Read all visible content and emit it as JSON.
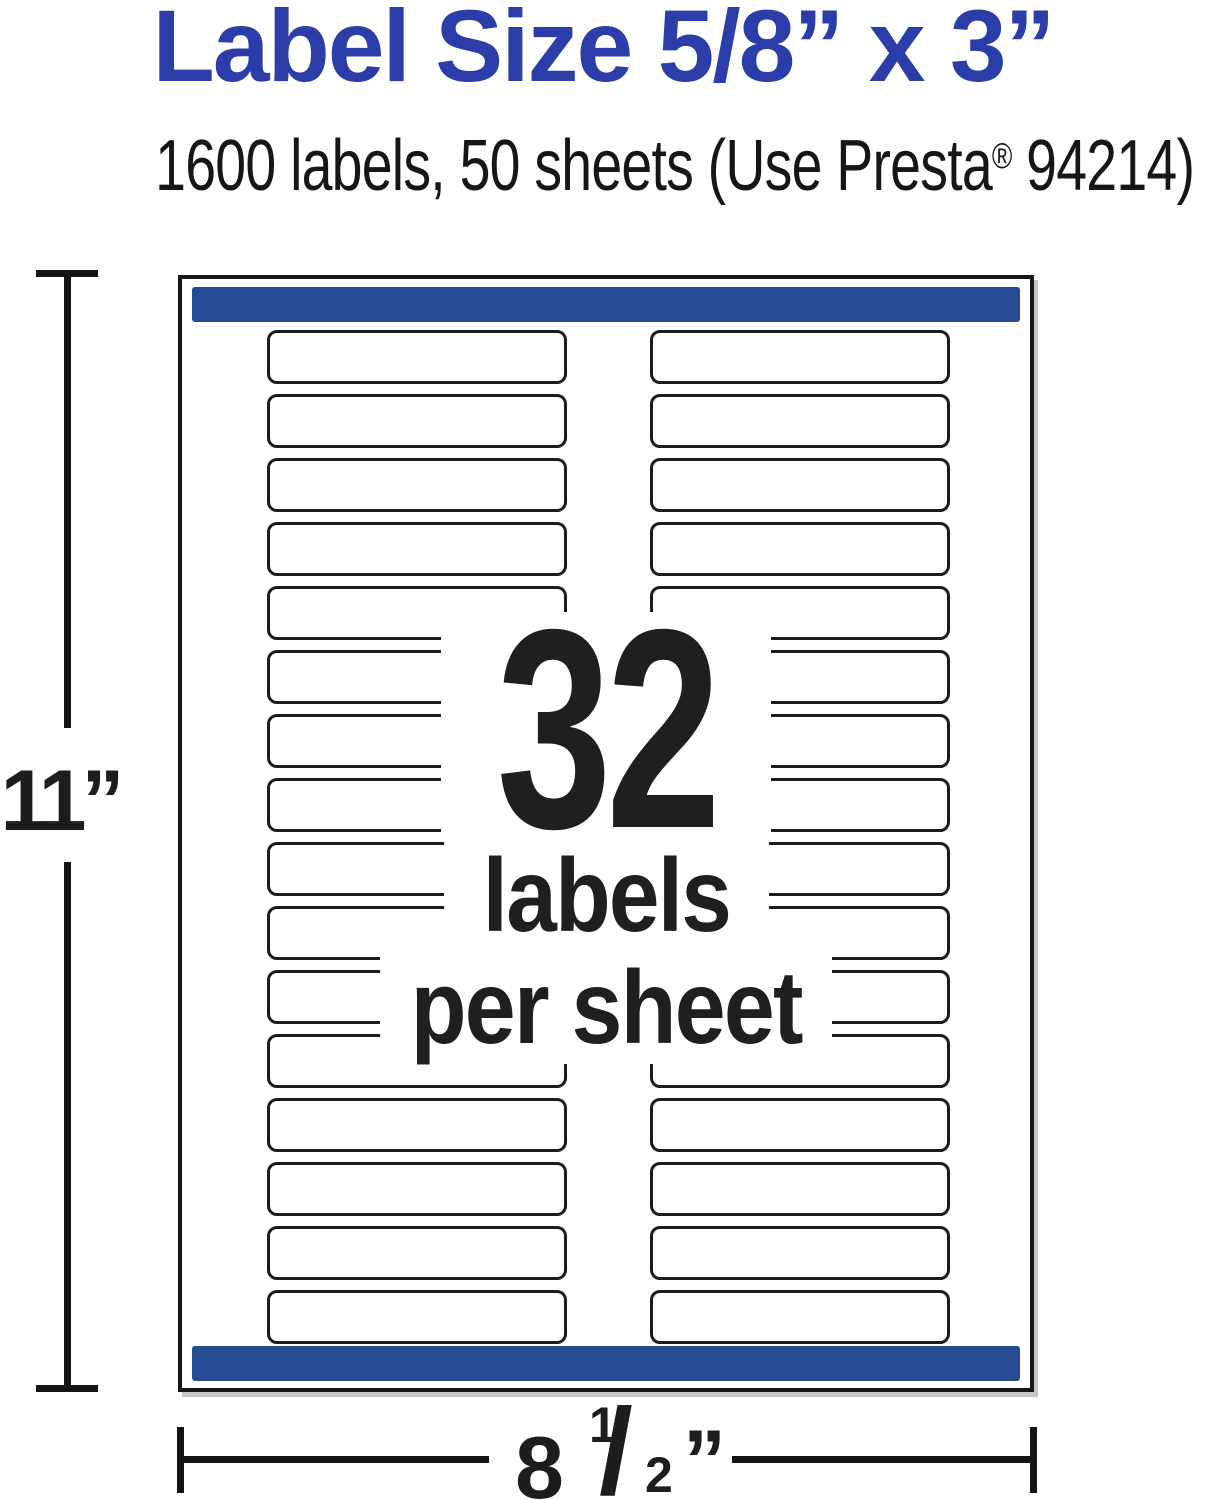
{
  "header": {
    "title": "Label Size 5/8” x 3”",
    "subtitle_pre": "1600 labels, 50 sheets (Use Presta",
    "subtitle_reg": "®",
    "subtitle_post": " 94214)"
  },
  "sheet": {
    "columns": 2,
    "rows_per_column": 16,
    "total_labels": 32,
    "overlay": {
      "number": "32",
      "line2": "labels",
      "line3": "per sheet"
    }
  },
  "dimensions": {
    "height_label": "11”",
    "width_label": {
      "whole": "8",
      "numerator": "1",
      "slash": "/",
      "denominator": "2",
      "unit": "”"
    }
  },
  "colors": {
    "title_blue": "#2b3da9",
    "bar_blue": "#254b92",
    "ink": "#1d1d1b"
  }
}
